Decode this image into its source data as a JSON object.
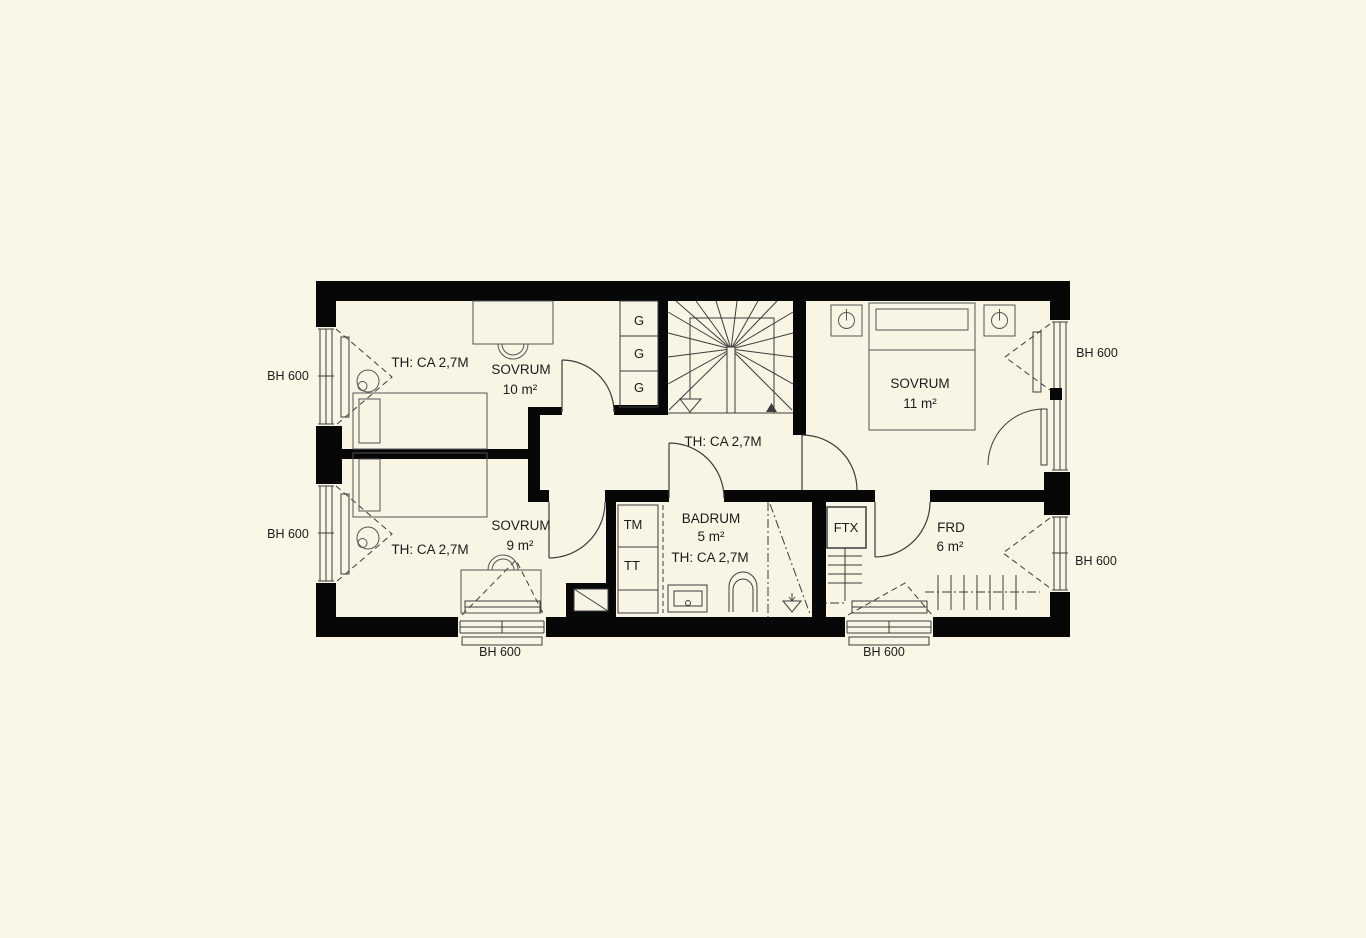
{
  "colors": {
    "background": "#faf7e6",
    "wall": "#070707",
    "line": "#3c3c3c",
    "furniture": "#555555",
    "text": "#1b1b1b"
  },
  "rooms": {
    "sovrum10": {
      "name": "SOVRUM",
      "area": "10 m²",
      "ceiling": "TH: CA 2,7M"
    },
    "sovrum9": {
      "name": "SOVRUM",
      "area": "9 m²",
      "ceiling": "TH: CA 2,7M"
    },
    "sovrum11": {
      "name": "SOVRUM",
      "area": "11 m²"
    },
    "hall": {
      "ceiling": "TH: CA 2,7M"
    },
    "badrum": {
      "name": "BADRUM",
      "area": "5 m²",
      "ceiling": "TH: CA 2,7M"
    },
    "frd": {
      "name": "FRD",
      "area": "6 m²"
    }
  },
  "fixtures": {
    "ftx": "FTX",
    "tm": "TM",
    "tt": "TT",
    "wardrobe": "G"
  },
  "window_labels": {
    "left_top": "BH 600",
    "left_bottom": "BH 600",
    "right_top": "BH 600",
    "right_bottom": "BH 600",
    "bottom_left": "BH 600",
    "bottom_right": "BH 600"
  }
}
